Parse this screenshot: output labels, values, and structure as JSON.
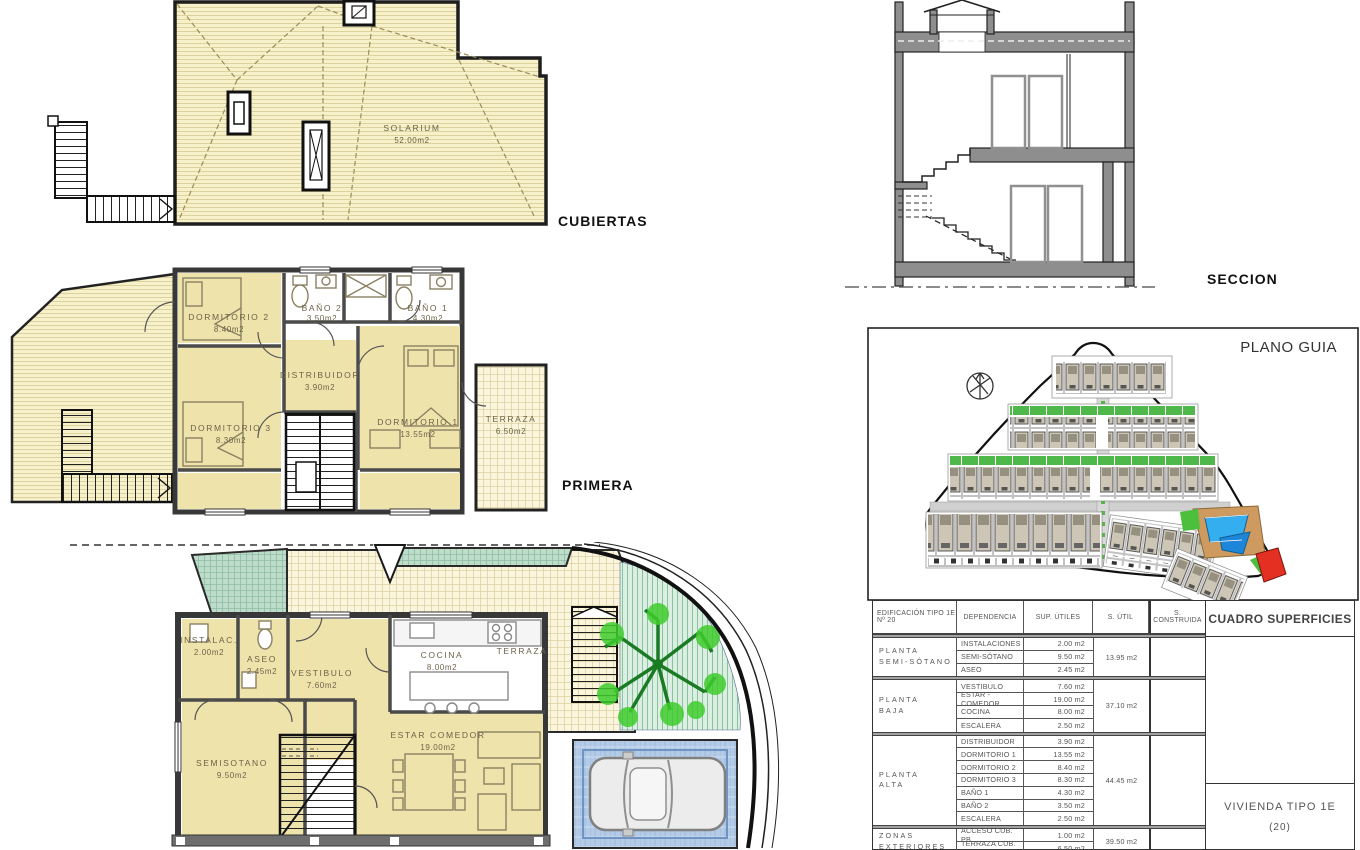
{
  "labels": {
    "cubiertas": "CUBIERTAS",
    "primera": "PRIMERA",
    "seccion": "SECCION",
    "plano_guia": "PLANO GUIA"
  },
  "roof_plan": {
    "room": "SOLARIUM",
    "area": "52.00m2"
  },
  "first_floor": {
    "rooms": [
      {
        "name": "DORMITORIO 2",
        "area": "8.40m2"
      },
      {
        "name": "BAÑO 2",
        "area": "3.50m2"
      },
      {
        "name": "BAÑO 1",
        "area": "4.30m2"
      },
      {
        "name": "DISTRIBUIDOR",
        "area": "3.90m2"
      },
      {
        "name": "DORMITORIO 3",
        "area": "8.30m2"
      },
      {
        "name": "DORMITORIO 1",
        "area": "13.55m2"
      },
      {
        "name": "TERRAZA",
        "area": "6.50m2"
      }
    ]
  },
  "ground_floor": {
    "rooms": [
      {
        "name": "INSTALAC.",
        "area": "2.00m2"
      },
      {
        "name": "ASEO",
        "area": "2.45m2"
      },
      {
        "name": "VESTIBULO",
        "area": "7.60m2"
      },
      {
        "name": "COCINA",
        "area": "8.00m2"
      },
      {
        "name": "ESTAR COMEDOR",
        "area": "19.00m2"
      },
      {
        "name": "SEMISOTANO",
        "area": "9.50m2"
      },
      {
        "name": "TERRAZA",
        "area": ""
      }
    ]
  },
  "table": {
    "header": {
      "col1_line1": "EDIFICACIÓN TIPO 1E",
      "col1_line2": "Nº 20",
      "col2": "DEPENDENCIA",
      "col3": "SUP. ÚTILES",
      "col4": "S. ÚTIL",
      "col5": "S. CONSTRUIDA"
    },
    "right": {
      "title": "CUADRO SUPERFICIES",
      "unit_line1": "VIVIENDA TIPO 1E",
      "unit_line2": "(20)"
    },
    "groups": [
      {
        "floor_line1": "PLANTA",
        "floor_line2": "SEMI-SÓTANO",
        "rows": [
          [
            "INSTALACIONES",
            "2.00 m2"
          ],
          [
            "SEMI-SÓTANO",
            "9.50 m2"
          ],
          [
            "ASEO",
            "2.45 m2"
          ]
        ],
        "total": "13.95 m2",
        "construida": ""
      },
      {
        "floor_line1": "PLANTA",
        "floor_line2": "BAJA",
        "rows": [
          [
            "VESTIBULO",
            "7.60 m2"
          ],
          [
            "ESTAR - COMEDOR",
            "19.00 m2"
          ],
          [
            "COCINA",
            "8.00 m2"
          ],
          [
            "ESCALERA",
            "2.50 m2"
          ]
        ],
        "total": "37.10 m2",
        "construida": ""
      },
      {
        "floor_line1": "PLANTA",
        "floor_line2": "ALTA",
        "rows": [
          [
            "DISTRIBUIDOR",
            "3.90 m2"
          ],
          [
            "DORMITORIO 1",
            "13.55 m2"
          ],
          [
            "DORMITORIO 2",
            "8.40 m2"
          ],
          [
            "DORMITORIO 3",
            "8.30 m2"
          ],
          [
            "BAÑO 1",
            "4.30 m2"
          ],
          [
            "BAÑO 2",
            "3.50 m2"
          ],
          [
            "ESCALERA",
            "2.50 m2"
          ]
        ],
        "total": "44.45 m2",
        "construida": ""
      },
      {
        "floor_line1": "ZONAS",
        "floor_line2": "EXTERIORES",
        "rows": [
          [
            "ACCESO CUB. PB",
            "1.00 m2"
          ],
          [
            "TERRAZA CUB. PA",
            "6.50 m2"
          ]
        ],
        "total": "39.50 m2",
        "construida": ""
      }
    ]
  },
  "colors": {
    "roof_cream": "#F7F1CB",
    "room_tan": "#EFE3AC",
    "wall_dark": "#383838",
    "teal_grid": "#BEDCCA",
    "garden_green": "#4FB84A",
    "pool_blue": "#35AEF0",
    "paving_blue": "#B3CBE7",
    "highlight_red": "#E33023"
  }
}
